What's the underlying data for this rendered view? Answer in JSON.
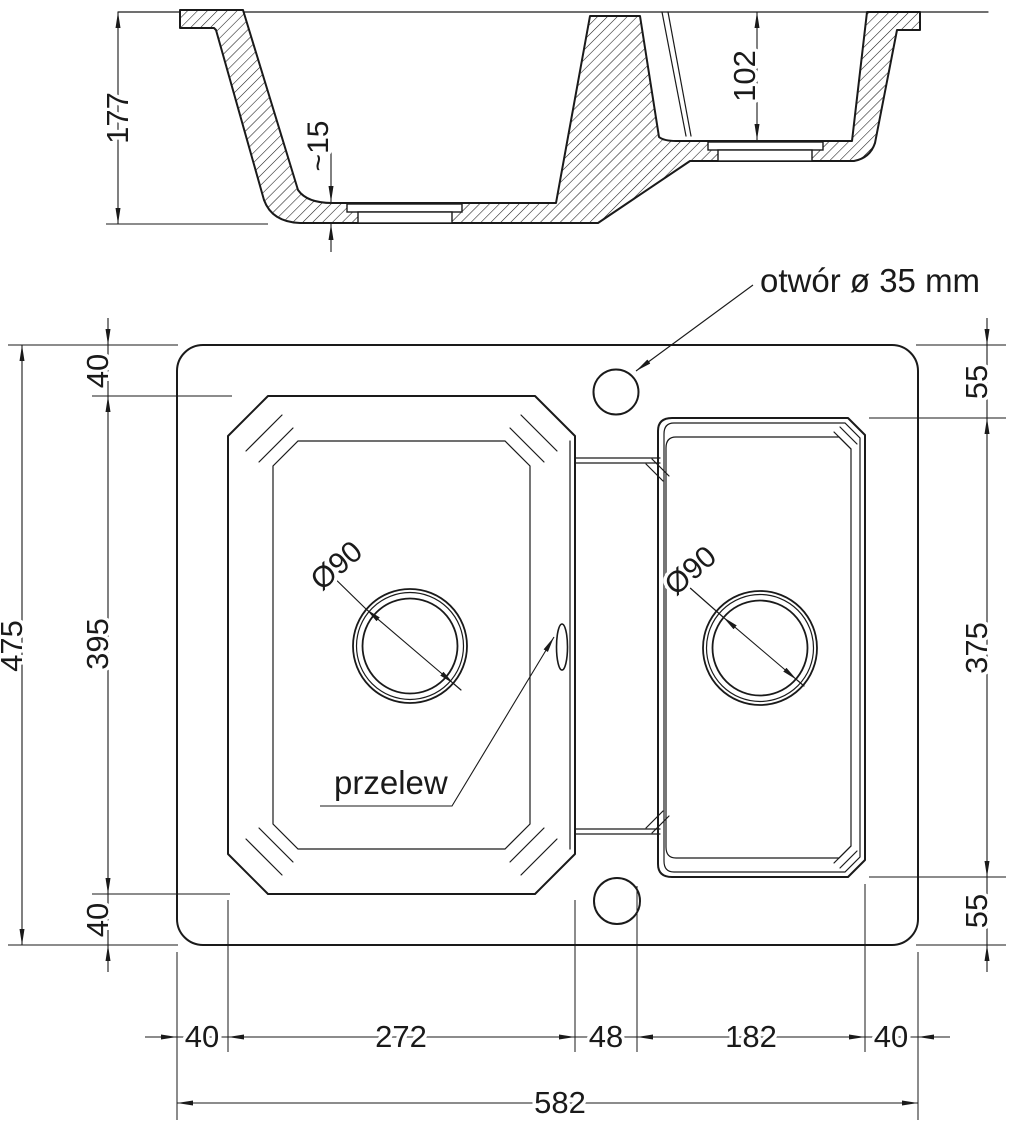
{
  "colors": {
    "line": "#1a1a1a",
    "background": "#ffffff"
  },
  "section_view": {
    "depth_left": "177",
    "floor_thickness": "~15",
    "depth_right": "102"
  },
  "plan_view": {
    "hole_note": "otwór ø 35 mm",
    "overflow_label": "przelew",
    "drain_left_diameter": "Ø90",
    "drain_right_diameter": "Ø90",
    "left_chain": {
      "total_height": "475",
      "top_margin": "40",
      "basin_height": "395",
      "bottom_margin": "40"
    },
    "right_chain": {
      "top_margin": "55",
      "basin_height": "375",
      "bottom_margin": "55"
    },
    "bottom_chain": {
      "left_margin": "40",
      "left_basin_width": "272",
      "divider_width": "48",
      "right_basin_width": "182",
      "right_margin": "40",
      "total_width": "582"
    }
  }
}
